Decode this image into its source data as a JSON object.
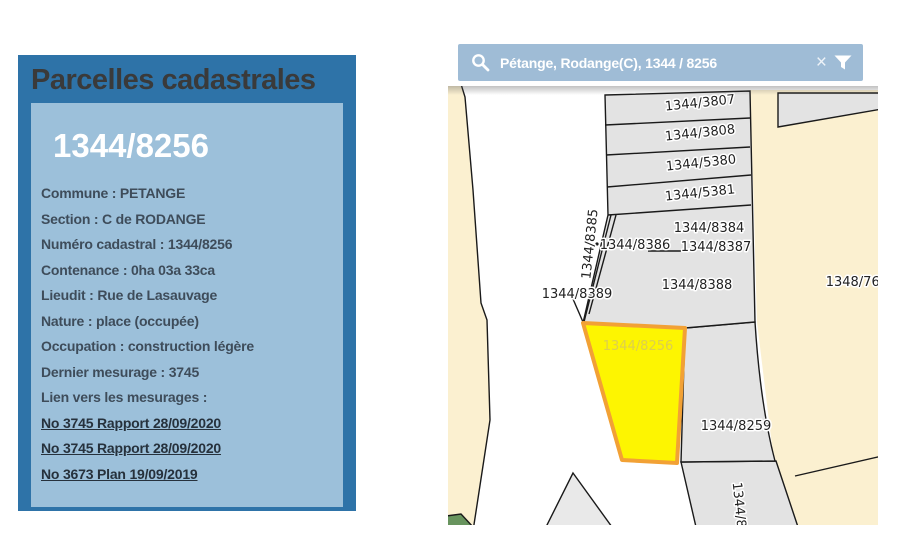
{
  "panel": {
    "title": "Parcelles cadastrales",
    "parcel_number": "1344/8256",
    "details": [
      "Commune : PETANGE",
      "Section : C de RODANGE",
      "Numéro cadastral : 1344/8256",
      "Contenance : 0ha 03a 33ca",
      "Lieudit : Rue de Lasauvage",
      "Nature : place (occupée)",
      "Occupation : construction légère",
      "Dernier mesurage : 3745",
      "Lien vers les mesurages :"
    ],
    "links": [
      "No 3745 Rapport 28/09/2020",
      "No 3745 Rapport 28/09/2020",
      "No 3673 Plan 19/09/2019"
    ],
    "colors": {
      "frame": "#2e73a8",
      "inner": "#9cc0da",
      "title_text": "#3a3a3a",
      "number_text": "#ffffff",
      "detail_text": "#3e4c5a",
      "link_text": "#26313c"
    }
  },
  "search": {
    "value": "Pétange, Rodange(C), 1344 / 8256",
    "clear_glyph": "×",
    "icons": [
      "search-icon",
      "clear-icon",
      "filter-icon"
    ],
    "colors": {
      "bar": "#9fbcd6",
      "text": "#ffffff"
    }
  },
  "map": {
    "highlighted_parcel": "1344/8256",
    "labels": [
      "1344/3807",
      "1344/3808",
      "1344/5380",
      "1344/5381",
      "1344/8384",
      "1344/8386",
      "1344/8387",
      "1344/8388",
      "1344/8385",
      "1344/8389",
      "1348/7602",
      "1344/8256",
      "1344/8259",
      "1344/8"
    ],
    "colors": {
      "parcel_fill": "#e3e3e3",
      "boundary": "#1a1a1a",
      "zone_fill": "#fbf0d0",
      "highlight_fill": "#fdf501",
      "highlight_stroke": "#f2a135",
      "highlight_label": "#ddcf4e",
      "green_fill": "#68945e",
      "label_text": "#222222"
    }
  }
}
